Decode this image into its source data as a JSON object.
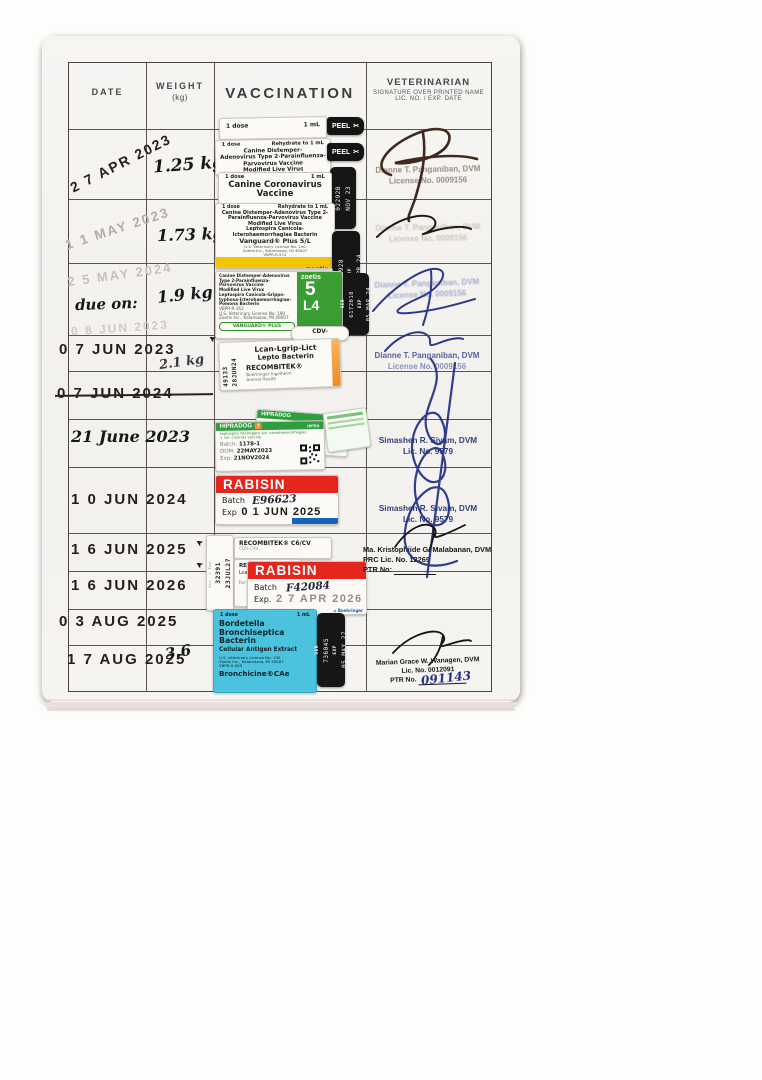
{
  "icons": {
    "scissors": "✂",
    "arrow": "➤",
    "home": "⌂"
  },
  "table": {
    "header": {
      "date": "DATE",
      "weight": "WEIGHT",
      "weight_sub": "(kg)",
      "vaccination": "VACCINATION",
      "vet": "VETERINARIAN",
      "vet_sub1": "SIGNATURE OVER PRINTED NAME",
      "vet_sub2": "LIC. NO. / EXP. DATE"
    },
    "rows": [
      {
        "date": "2 7 APR 2023",
        "weight": "1.25 kg"
      },
      {
        "date": "1 1 MAY 2023",
        "weight": "1.73 kg"
      },
      {
        "date_top": "2 5 MAY 2024",
        "date_hand": "due on:",
        "date_bottom": "0 8 JUN 2023",
        "weight": "1.9 kg"
      },
      {
        "date": "0 7 JUN 2023",
        "weight": "2.1 kg"
      },
      {
        "date": "0 7 JUN 2024"
      },
      {
        "date": "21 June 2023"
      },
      {
        "date": "1 0 JUN 2024"
      },
      {
        "date": "1 6 JUN 2025"
      },
      {
        "date": "1 6 JUN 2026"
      },
      {
        "date": "0 3 AUG 2025"
      },
      {
        "date": "1 7 AUG 2025",
        "weight": "3.6"
      }
    ]
  },
  "vets": {
    "panganiban": {
      "name": "Dianne T. Panganiban, DVM",
      "lic": "License No. 0009156"
    },
    "sivam": {
      "name": "Simashen R. Sivam, DVM",
      "lic": "Lic. No. 9579"
    },
    "malabanan": {
      "name": "Ma. Kristophiide G. Malabanan, DVM",
      "lic": "PRC Lic. No. 12269",
      "ptr": "PTR No:"
    },
    "wanagen": {
      "name": "Marian Grace W. Wanagen, DVM",
      "lic": "Lic. No. 0012091",
      "ptr": "PTR No.",
      "ptr_hand": "091143"
    }
  },
  "stickers": {
    "peel": "PEEL",
    "r1_top": {
      "dose": "1 dose",
      "vol": "1 mL"
    },
    "r1_main": {
      "dose": "1 dose",
      "rehydrate": "Rehydrate to 1 mL",
      "l1": "Canine Distemper-",
      "l2": "Adenovirus Type 2-Parainfluenza-",
      "l3": "Parvovirus Vaccine",
      "l4": "Modified Live Virus",
      "name": "Vanguard® Plus 5"
    },
    "r1_tab": {
      "ser": "02292B",
      "exp": "NOV 23"
    },
    "r2_corona": {
      "dose": "1 dose",
      "vol": "1 mL",
      "l1": "Canine Coronavirus",
      "l2": "Vaccine"
    },
    "r2_vanguard": {
      "dose": "1 dose",
      "rehydrate": "Rehydrate to 1 mL",
      "l1": "Canine Distemper-Adenovirus Type 2-",
      "l2": "Parainfluenza-Parvovirus Vaccine",
      "l3": "Modified Live Virus",
      "l4": "Leptospira Canicola-",
      "l5": "Icterohaemorrhagiae Bacterin",
      "name": "Vanguard® Plus 5/L",
      "l6": "U.S. Veterinary License No. 190",
      "l7": "Zoetis Inc., Kalamazoo, MI 49007",
      "l8": "VBPR-R-572",
      "brand": "zoetis"
    },
    "r2_tab": {
      "ser_label": "SER",
      "ser": "6221928",
      "exp_label": "EXP",
      "exp": "09 APR 24"
    },
    "r3_vanguard": {
      "dose": "1 dose",
      "rehydrate": "Rehydrate to 1 mL",
      "l1": "Canine Distemper-Adenovirus",
      "l2": "Type 2-Parainfluenza-",
      "l3": "Parvovirus Vaccine",
      "l4": "Modified Live Virus",
      "l5": "Leptospira Canicola-Grippo-",
      "l6": "typhosa-Icterohaemorrhagiae-",
      "l7": "Pomona Bacterin",
      "l8": "VBPR-R-162",
      "l9": "U.S. Veterinary License No. 190",
      "l10": "Zoetis Inc., Kalamazoo, MI 49007",
      "badge": "VANGUARD® PLUS",
      "brand": "zoetis",
      "big1": "5",
      "big2": "L4"
    },
    "r3_tab": {
      "ser_label": "SER",
      "ser": "6172018",
      "exp_label": "EXP",
      "exp": "05 MAR 24"
    },
    "r4_recombitek": {
      "tab": "CDV-",
      "ser": "49133",
      "exp": "28JUN24",
      "l1": "Lcan-Lgrip-Lict",
      "l2": "Lepto Bacterin",
      "name": "RECOMBITEK®",
      "m1": "Boehringer Ingelheim",
      "m2": "Animal Health"
    },
    "r6_hipradog": {
      "brand": "HIPRADOG",
      "seven": "7",
      "hipra": "HIPRA",
      "desc1": "Leptospira interrogans ser. icterohaemorrhagiae",
      "desc2": "+ ser. canicola vaccine",
      "batch_label": "Batch:",
      "batch": "1178-1",
      "dom_label": "DOM:",
      "dom": "22MAY2023",
      "exp_label": "Exp:",
      "exp": "21NOV2024"
    },
    "r7_rabisin": {
      "name": "RABISIN",
      "batch_label": "Batch",
      "batch": "E96623",
      "exp_label": "Exp",
      "exp": "0 1 JUN 2025"
    },
    "r8_recombitek": {
      "l1": "RECOMBITEK® C6/CV",
      "l2": "CDV-CAV…",
      "side": "Ser. / Exp.",
      "ser": "32391",
      "exp": "23JUL27"
    },
    "r9_recombitek": {
      "l1": "RECOMBITEK®",
      "l2": "Lcan-Lict Bacterin",
      "l3": "For veterinary use"
    },
    "r9_rabisin": {
      "name": "RABISIN",
      "batch_label": "Batch",
      "batch": "F42084",
      "exp_label": "Exp.",
      "exp": "2 7 APR 2026",
      "logo": "Boehringer"
    },
    "r11_bronchicine": {
      "dose": "1 dose",
      "vol": "1 mL",
      "l1": "Bordetella",
      "l2": "Bronchiseptica Bacterin",
      "l3": "Cellular Antigen Extract",
      "l4": "U.S. Veterinary License No. 190",
      "l5": "Zoetis Inc., Kalamazoo, MI 49007",
      "l6": "VBPR-9-908",
      "name": "Bronchicine®CAe"
    },
    "r11_tab": {
      "ser_label": "SER",
      "ser": "736045",
      "exp_label": "EXP",
      "exp": "05 MAY 27"
    }
  }
}
